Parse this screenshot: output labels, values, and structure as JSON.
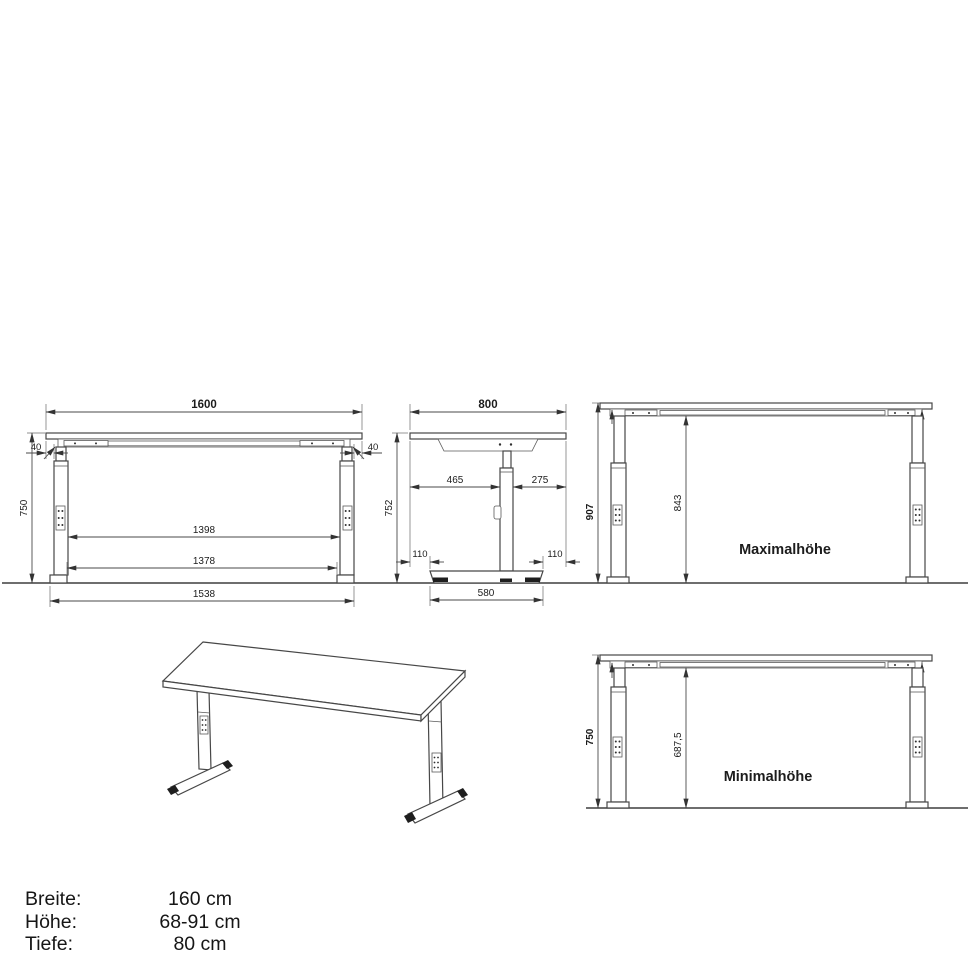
{
  "front_view": {
    "top_width": "1600",
    "left_offset": "40",
    "right_offset": "40",
    "height": "750",
    "inner_width": "1398",
    "leg_inner_width": "1378",
    "foot_span": "1538"
  },
  "side_view": {
    "depth": "800",
    "front_overhang": "465",
    "rear_overhang": "275",
    "height": "752",
    "foot_front_offset": "110",
    "foot_rear_offset": "110",
    "foot_length": "580"
  },
  "max_view": {
    "label": "Maximalhöhe",
    "total_height": "907",
    "clearance": "843"
  },
  "min_view": {
    "label": "Minimalhöhe",
    "total_height": "750",
    "clearance": "687,5"
  },
  "specs": {
    "rows": [
      {
        "label": "Breite:",
        "value": "160 cm"
      },
      {
        "label": "Höhe:",
        "value": "68-91 cm"
      },
      {
        "label": "Tiefe:",
        "value": "80 cm"
      }
    ]
  },
  "colors": {
    "line": "#474747",
    "text": "#1c1c1c",
    "background": "#ffffff"
  }
}
